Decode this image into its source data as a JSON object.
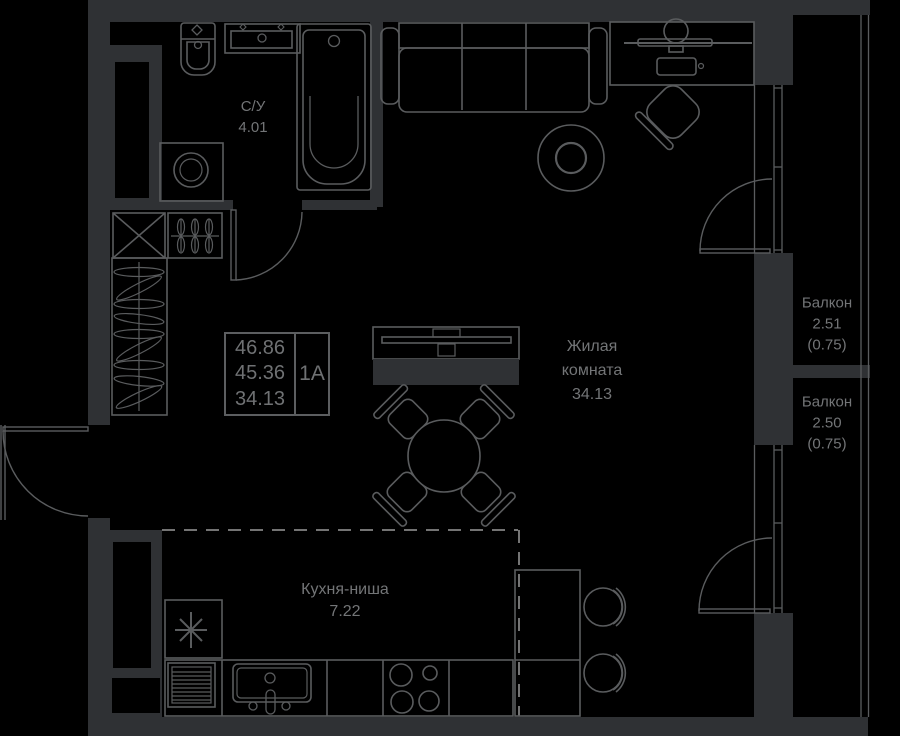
{
  "plan_title": "apartment-floor-plan",
  "colors": {
    "background": "#000000",
    "wall_fill": "#2f3134",
    "line": "#5a5c5e",
    "dash_line": "#9a9a9a",
    "text": "#737577"
  },
  "info_box": {
    "values": [
      "46.86",
      "45.36",
      "34.13"
    ],
    "unit": "1А"
  },
  "rooms": {
    "bathroom": {
      "name": "С/У",
      "area": "4.01"
    },
    "living": {
      "name_line1": "Жилая",
      "name_line2": "комната",
      "area": "34.13"
    },
    "kitchen": {
      "name": "Кухня-ниша",
      "area": "7.22"
    },
    "balcony_top": {
      "name": "Балкон",
      "area": "2.51",
      "coef": "(0.75)"
    },
    "balcony_bottom": {
      "name": "Балкон",
      "area": "2.50",
      "coef": "(0.75)"
    }
  }
}
